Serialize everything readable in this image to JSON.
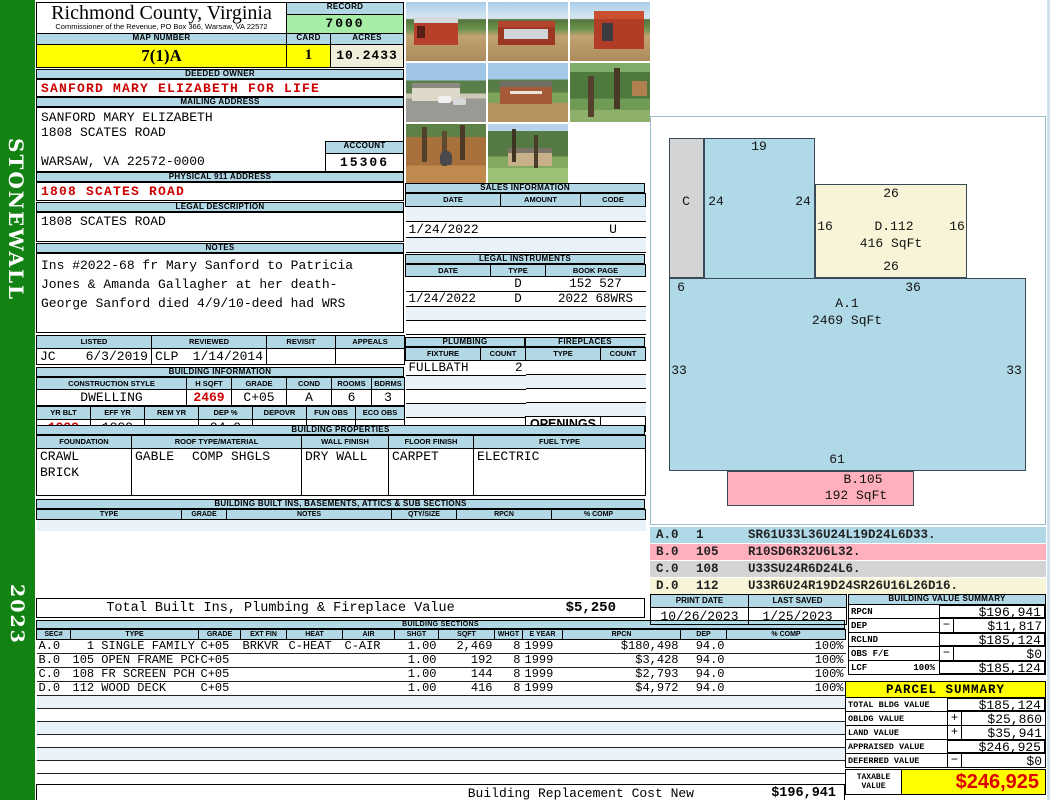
{
  "sidebar": {
    "district": "STONEWALL",
    "year": "2023"
  },
  "header": {
    "county_name": "Richmond County, Virginia",
    "commissioner_line": "Commissioner of the Revenue, PO Box 366, Warsaw, VA 22572",
    "record_label": "RECORD",
    "record_value": "7000",
    "map_number_label": "MAP NUMBER",
    "map_number_value": "7(1)A",
    "card_label": "CARD",
    "card_value": "1",
    "acres_label": "ACRES",
    "acres_value": "10.2433"
  },
  "owner": {
    "deeded_owner_label": "DEEDED OWNER",
    "deeded_owner": "SANFORD MARY ELIZABETH FOR LIFE",
    "mailing_address_label": "MAILING ADDRESS",
    "mailing_name": "SANFORD MARY ELIZABETH",
    "mailing_street": "1808 SCATES ROAD",
    "mailing_city": "WARSAW, VA 22572-0000",
    "account_label": "ACCOUNT",
    "account_value": "15306",
    "physical_address_label": "PHYSICAL 911 ADDRESS",
    "physical_address": "1808 SCATES ROAD",
    "legal_description_label": "LEGAL DESCRIPTION",
    "legal_description": "1808 SCATES ROAD",
    "notes_label": "NOTES",
    "notes_line1": "Ins #2022-68 fr Mary Sanford to Patricia",
    "notes_line2": "Jones & Amanda Gallagher at her death-",
    "notes_line3": "George Sanford died 4/9/10-deed had WRS"
  },
  "review": {
    "listed_label": "LISTED",
    "listed_by": "JC",
    "listed_date": "6/3/2019",
    "reviewed_label": "REVIEWED",
    "reviewed_by": "CLP",
    "reviewed_date": "1/14/2014",
    "revisit_label": "REVISIT",
    "revisit_value": "",
    "appeals_label": "APPEALS",
    "appeals_value": ""
  },
  "building_information": {
    "title": "BUILDING INFORMATION",
    "style_label": "CONSTRUCTION STYLE",
    "style": "DWELLING",
    "hsqft_label": "H SQFT",
    "hsqft": "2469",
    "grade_label": "GRADE",
    "grade": "C+05",
    "cond_label": "COND",
    "cond": "A",
    "rooms_label": "ROOMS",
    "rooms": "6",
    "bdrms_label": "BDRMS",
    "bdrms": "3",
    "yrblt_label": "YR BLT",
    "yrblt": "1999",
    "effyr_label": "EFF YR",
    "effyr": "1999",
    "remyr_label": "REM YR",
    "remyr": "",
    "dep_label": "DEP %",
    "dep": "94.0",
    "depovr_label": "DEPOVR",
    "depovr": "",
    "funobs_label": "FUN OBS",
    "funobs": "",
    "ecoobs_label": "ECO OBS",
    "ecoobs": ""
  },
  "sales_information": {
    "title": "SALES INFORMATION",
    "headers": [
      "DATE",
      "AMOUNT",
      "CODE"
    ],
    "rows": [
      {
        "date": "",
        "amount": "",
        "code": ""
      },
      {
        "date": "1/24/2022",
        "amount": "",
        "code": "U"
      },
      {
        "date": "",
        "amount": "",
        "code": ""
      }
    ]
  },
  "legal_instruments": {
    "title": "LEGAL INSTRUMENTS",
    "headers": [
      "DATE",
      "TYPE",
      "BOOK PAGE"
    ],
    "rows": [
      {
        "date": "",
        "type": "D",
        "book_page": "152 527"
      },
      {
        "date": "1/24/2022",
        "type": "D",
        "book_page": "2022 68WRS"
      },
      {
        "date": "",
        "type": "",
        "book_page": ""
      },
      {
        "date": "",
        "type": "",
        "book_page": ""
      }
    ]
  },
  "plumbing": {
    "title": "PLUMBING",
    "headers": [
      "FIXTURE",
      "COUNT"
    ],
    "rows": [
      {
        "fixture": "FULLBATH",
        "count": "2"
      },
      {
        "fixture": "",
        "count": ""
      },
      {
        "fixture": "",
        "count": ""
      },
      {
        "fixture": "",
        "count": ""
      }
    ]
  },
  "fireplaces": {
    "title": "FIREPLACES",
    "headers": [
      "TYPE",
      "COUNT"
    ],
    "rows": [
      {
        "type": "",
        "count": ""
      },
      {
        "type": "",
        "count": ""
      },
      {
        "type": "",
        "count": ""
      },
      {
        "type": "",
        "count": ""
      }
    ],
    "openings_label": "OPENINGS",
    "openings_value": ""
  },
  "building_properties": {
    "title": "BUILDING PROPERTIES",
    "foundation_label": "FOUNDATION",
    "foundation_line1": "CRAWL",
    "foundation_line2": "BRICK",
    "roof_label": "ROOF TYPE/MATERIAL",
    "roof_type": "GABLE",
    "roof_material": "COMP SHGLS",
    "wall_label": "WALL FINISH",
    "wall_finish": "DRY WALL",
    "floor_label": "FLOOR FINISH",
    "floor_finish": "CARPET",
    "fuel_label": "FUEL TYPE",
    "fuel_type": "ELECTRIC"
  },
  "built_ins": {
    "title": "BUILDING BUILT INS, BASEMENTS, ATTICS & SUB SECTIONS",
    "headers": [
      "TYPE",
      "GRADE",
      "NOTES",
      "QTY/SIZE",
      "RPCN",
      "% COMP"
    ]
  },
  "photos": [
    {
      "name": "red-barn-front"
    },
    {
      "name": "red-carport"
    },
    {
      "name": "red-barn-side"
    },
    {
      "name": "house-with-driveway"
    },
    {
      "name": "brick-house"
    },
    {
      "name": "yard-with-trees"
    },
    {
      "name": "dog-in-woods"
    },
    {
      "name": "house-behind-pines"
    }
  ],
  "sketch": {
    "labels": {
      "tab_top": "19",
      "c_name": "C",
      "tab_left": "24",
      "tab_right": "24",
      "d_top": "26",
      "d_left": "16",
      "d_name": "D.112",
      "d_sqft": "416 SqFt",
      "d_right": "16",
      "d_bottom": "26",
      "c_bottom": "6",
      "a_top": "36",
      "a_name": "A.1",
      "a_sqft": "2469 SqFt",
      "a_left": "33",
      "a_right": "33",
      "a_bottom": "61",
      "b_name": "B.105",
      "b_sqft": "192 SqFt"
    },
    "legend": [
      {
        "sec": "A.0",
        "code": "1",
        "path": "SR61U33L36U24L19D24L6D33."
      },
      {
        "sec": "B.0",
        "code": "105",
        "path": "R10SD6R32U6L32."
      },
      {
        "sec": "C.0",
        "code": "108",
        "path": "U33SU24R6D24L6."
      },
      {
        "sec": "D.0",
        "code": "112",
        "path": "U33R6U24R19D24SR26U16L26D16."
      }
    ]
  },
  "totals": {
    "built_ins_plumbing_label": "Total Built Ins, Plumbing & Fireplace Value",
    "built_ins_plumbing_value": "$5,250",
    "replacement_cost_label": "Building Replacement Cost New",
    "replacement_cost_value": "$196,941"
  },
  "print_info": {
    "print_date_label": "PRINT DATE",
    "print_date": "10/26/2023",
    "last_saved_label": "LAST SAVED",
    "last_saved": "1/25/2023"
  },
  "building_value_summary": {
    "title": "BUILDING VALUE SUMMARY",
    "rows": [
      {
        "label": "RPCN",
        "op": "",
        "value": "$196,941"
      },
      {
        "label": "DEP",
        "op": "−",
        "value": "$11,817"
      },
      {
        "label": "RCLND",
        "op": "",
        "value": "$185,124"
      },
      {
        "label": "OBS F/E",
        "op": "−",
        "value": "$0"
      },
      {
        "label": "LCF",
        "pct": "100%",
        "op": "",
        "value": "$185,124"
      }
    ]
  },
  "building_sections": {
    "title": "BUILDING SECTIONS",
    "headers": [
      "SEC#",
      "TYPE",
      "GRADE",
      "EXT FIN",
      "HEAT",
      "AIR",
      "SHGT",
      "SQFT",
      "WHGT",
      "E YEAR",
      "RPCN",
      "DEP",
      "% COMP"
    ],
    "rows": [
      {
        "sec": "A.0",
        "type": "  1 SINGLE FAMILY",
        "grade": "C+05",
        "ext_fin": "BRKVR",
        "heat": "C-HEAT",
        "air": "C-AIR",
        "shgt": "1.00",
        "sqft": "2,469",
        "whgt": "8",
        "e_year": "1999",
        "rpcn": "$180,498",
        "dep": "94.0",
        "comp": "100%"
      },
      {
        "sec": "B.0",
        "type": "105 OPEN FRAME PCH",
        "grade": "C+05",
        "ext_fin": "",
        "heat": "",
        "air": "",
        "shgt": "1.00",
        "sqft": "192",
        "whgt": "8",
        "e_year": "1999",
        "rpcn": "$3,428",
        "dep": "94.0",
        "comp": "100%"
      },
      {
        "sec": "C.0",
        "type": "108 FR SCREEN PCH",
        "grade": "C+05",
        "ext_fin": "",
        "heat": "",
        "air": "",
        "shgt": "1.00",
        "sqft": "144",
        "whgt": "8",
        "e_year": "1999",
        "rpcn": "$2,793",
        "dep": "94.0",
        "comp": "100%"
      },
      {
        "sec": "D.0",
        "type": "112 WOOD DECK",
        "grade": "C+05",
        "ext_fin": "",
        "heat": "",
        "air": "",
        "shgt": "1.00",
        "sqft": "416",
        "whgt": "8",
        "e_year": "1999",
        "rpcn": "$4,972",
        "dep": "94.0",
        "comp": "100%"
      }
    ]
  },
  "parcel_summary": {
    "title": "PARCEL SUMMARY",
    "rows": [
      {
        "label": "TOTAL BLDG VALUE",
        "op": "",
        "value": "$185,124"
      },
      {
        "label": "OBLDG VALUE",
        "op": "+",
        "value": "$25,860"
      },
      {
        "label": "LAND VALUE",
        "op": "+",
        "value": "$35,941"
      },
      {
        "label": "APPRAISED VALUE",
        "op": "",
        "value": "$246,925"
      },
      {
        "label": "DEFERRED VALUE",
        "op": "−",
        "value": "$0"
      }
    ],
    "taxable_label_line1": "TAXABLE",
    "taxable_label_line2": "VALUE",
    "taxable_value": "$246,925"
  },
  "colors": {
    "header_bar_blue": "#b2d7e5",
    "highlight_yellow": "#ffff00",
    "record_green": "#a6eda6",
    "cream": "#f0eedb",
    "alert_red": "#cc0000",
    "sidebar_green": "#128312",
    "sketch_blue": "#b0d9e8",
    "sketch_pink": "#ffb0bc",
    "sketch_gray": "#d4d4d4",
    "sketch_cream": "#f8f4d8"
  }
}
